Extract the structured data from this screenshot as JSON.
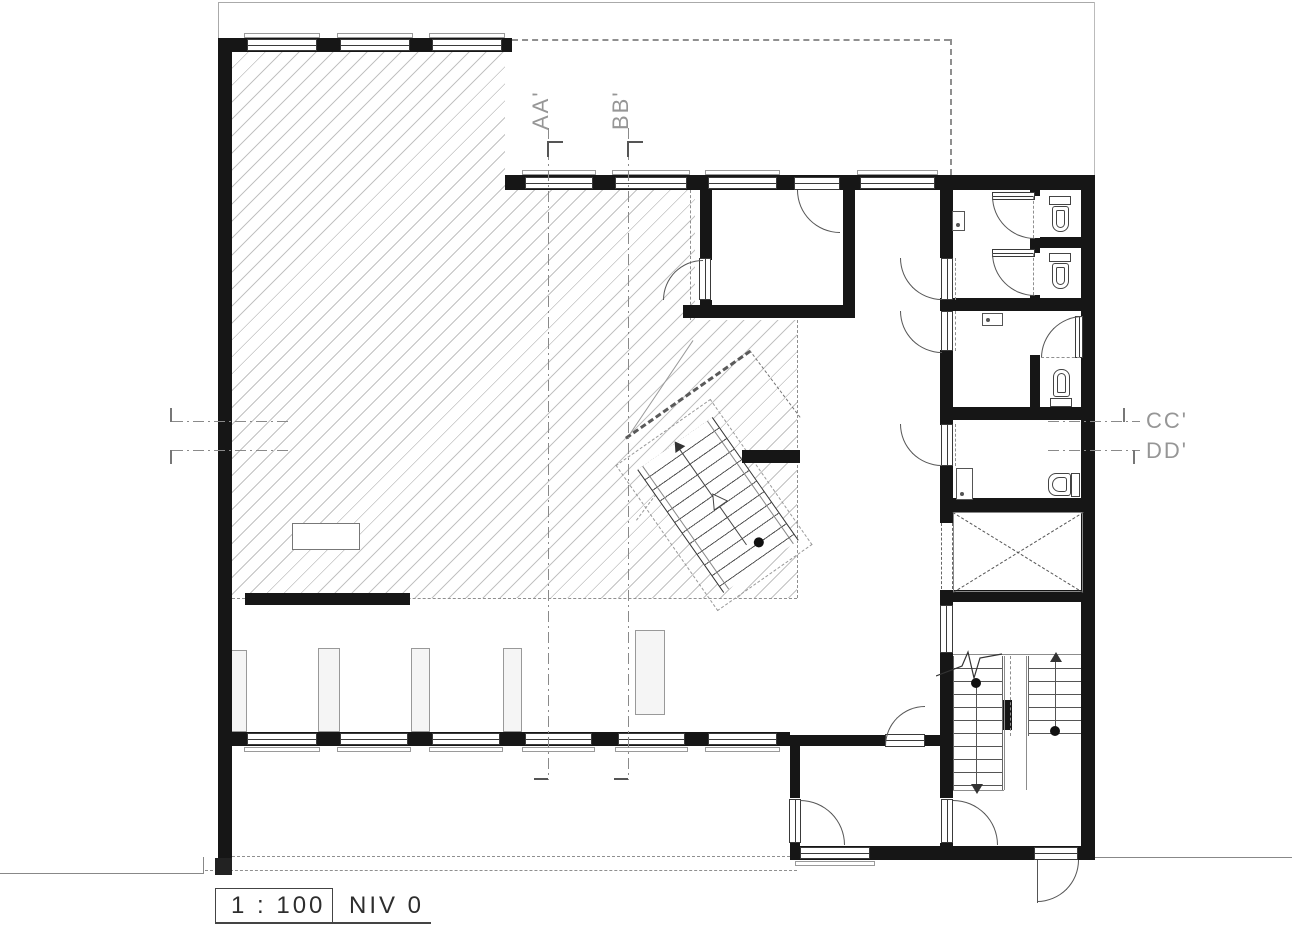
{
  "drawing": {
    "type_label": "floor-plan",
    "scale_label": "1 : 100",
    "level_label": "NIV 0",
    "sections": {
      "aa": "AA'",
      "bb": "BB'",
      "cc": "CC'",
      "dd": "DD'"
    },
    "colors": {
      "wall": "#161616",
      "hatch_line": "#c2c2c2",
      "dashed_line": "#8f8f8f",
      "section_label": "#969696",
      "text": "#2e2e2e",
      "background": "#ffffff"
    }
  }
}
